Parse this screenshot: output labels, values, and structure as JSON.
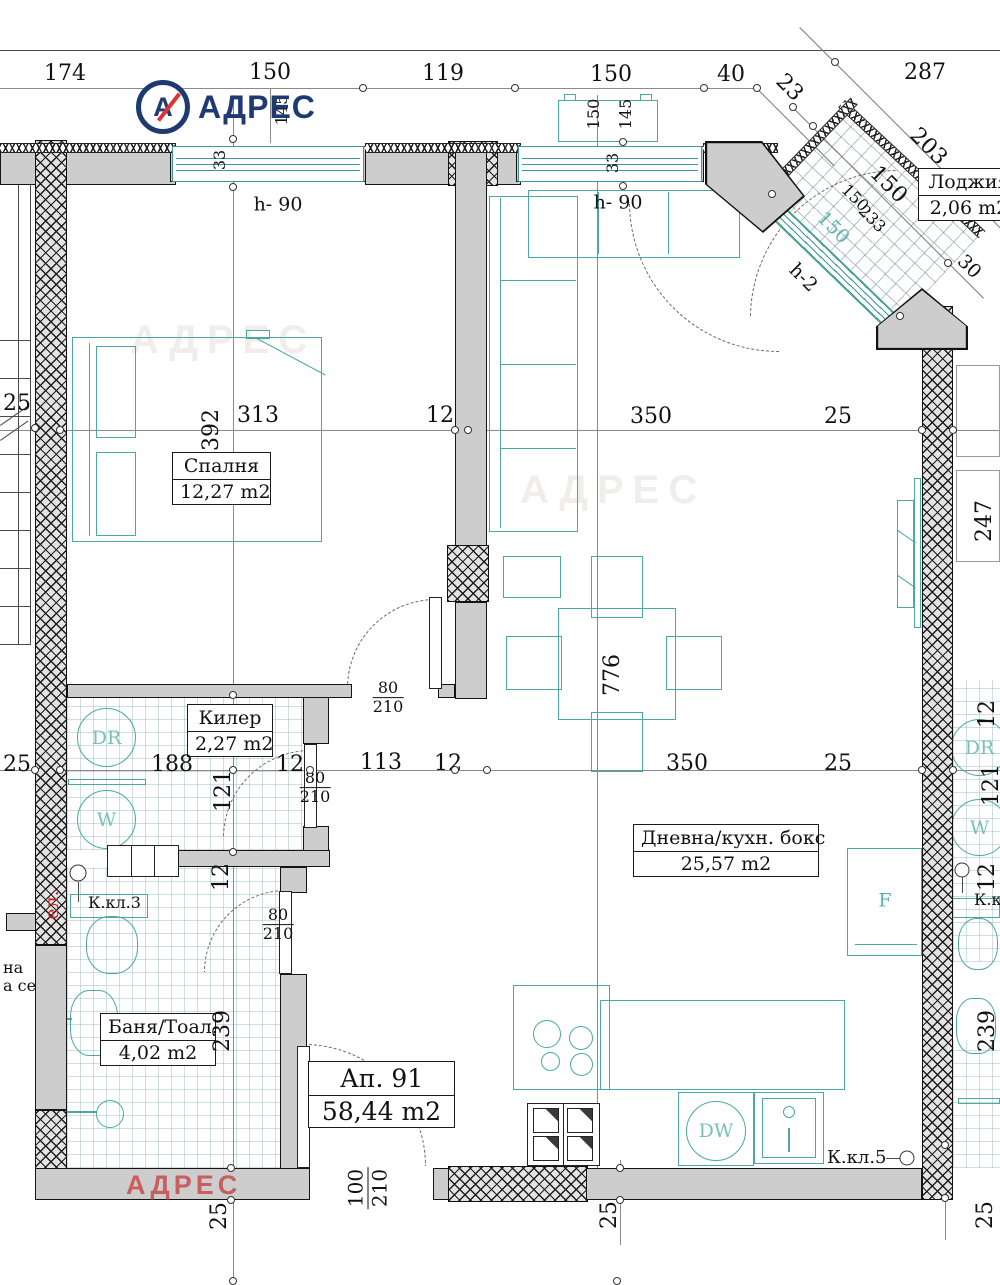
{
  "logo": {
    "mark": "А",
    "brand": "АДРЕС"
  },
  "watermark": {
    "red": "АДРЕС",
    "faint": "АДРЕС"
  },
  "top_dims": [
    "174",
    "150",
    "119",
    "150",
    "40",
    "23",
    "287"
  ],
  "facade": {
    "win_a": {
      "h": "145",
      "t": "33",
      "sill": "h- 90"
    },
    "win_b": {
      "w": "150",
      "h": "145",
      "t": "33",
      "sill": "h- 90"
    }
  },
  "loggia": {
    "name": "Лоджия",
    "area": "2,06 m2",
    "d203": "203",
    "d150": "150",
    "w150": "150",
    "w233": "233",
    "g150": "150",
    "d30": "30",
    "hh": "h-2"
  },
  "line1": {
    "l25": "25",
    "d392": "392",
    "d313": "313",
    "d12": "12",
    "d350": "350",
    "r25": "25",
    "d247": "247"
  },
  "line2": {
    "l25": "25",
    "d188": "188",
    "d12a": "12",
    "d121": "121",
    "d113": "113",
    "d12b": "12",
    "d350": "350",
    "r25": "25",
    "r12a": "12",
    "r121": "121",
    "l12": "12",
    "r12b": "12"
  },
  "vdims": {
    "d776": "776",
    "d239l": "239",
    "d239r": "239",
    "b25a": "25",
    "b25b": "25",
    "b25c": "25"
  },
  "doors": {
    "bedroom": {
      "w": "80",
      "h": "210"
    },
    "closet": {
      "w": "80",
      "h": "210"
    },
    "bath": {
      "w": "80",
      "h": "210"
    },
    "entry": {
      "w": "100",
      "h": "210"
    }
  },
  "rooms": {
    "bedroom": {
      "name": "Спалня",
      "area": "12,27 m2"
    },
    "closet": {
      "name": "Килер",
      "area": "2,27 m2"
    },
    "bath": {
      "name": "Баня/Тоал.",
      "area": "4,02 m2"
    },
    "living": {
      "name": "Дневна/кухн. бокс",
      "area": "25,57 m2"
    },
    "apt": {
      "name": "Ап. 91",
      "area": "58,44 m2"
    }
  },
  "appliances": {
    "dr": "DR",
    "w": "W",
    "dw": "DW",
    "f": "F",
    "dr_r": "DR",
    "w_r": "W"
  },
  "notes": {
    "kkl3": "К.кл.3",
    "kkl5": "К.кл.5",
    "kkl_r": "К.кл.",
    "el": "ел.",
    "edge1": "на",
    "edge2": "а се"
  },
  "colors": {
    "teal": "#4aa9a2",
    "wall": "#cdcdcd",
    "navy": "#1e3a70",
    "red": "#d94040"
  }
}
